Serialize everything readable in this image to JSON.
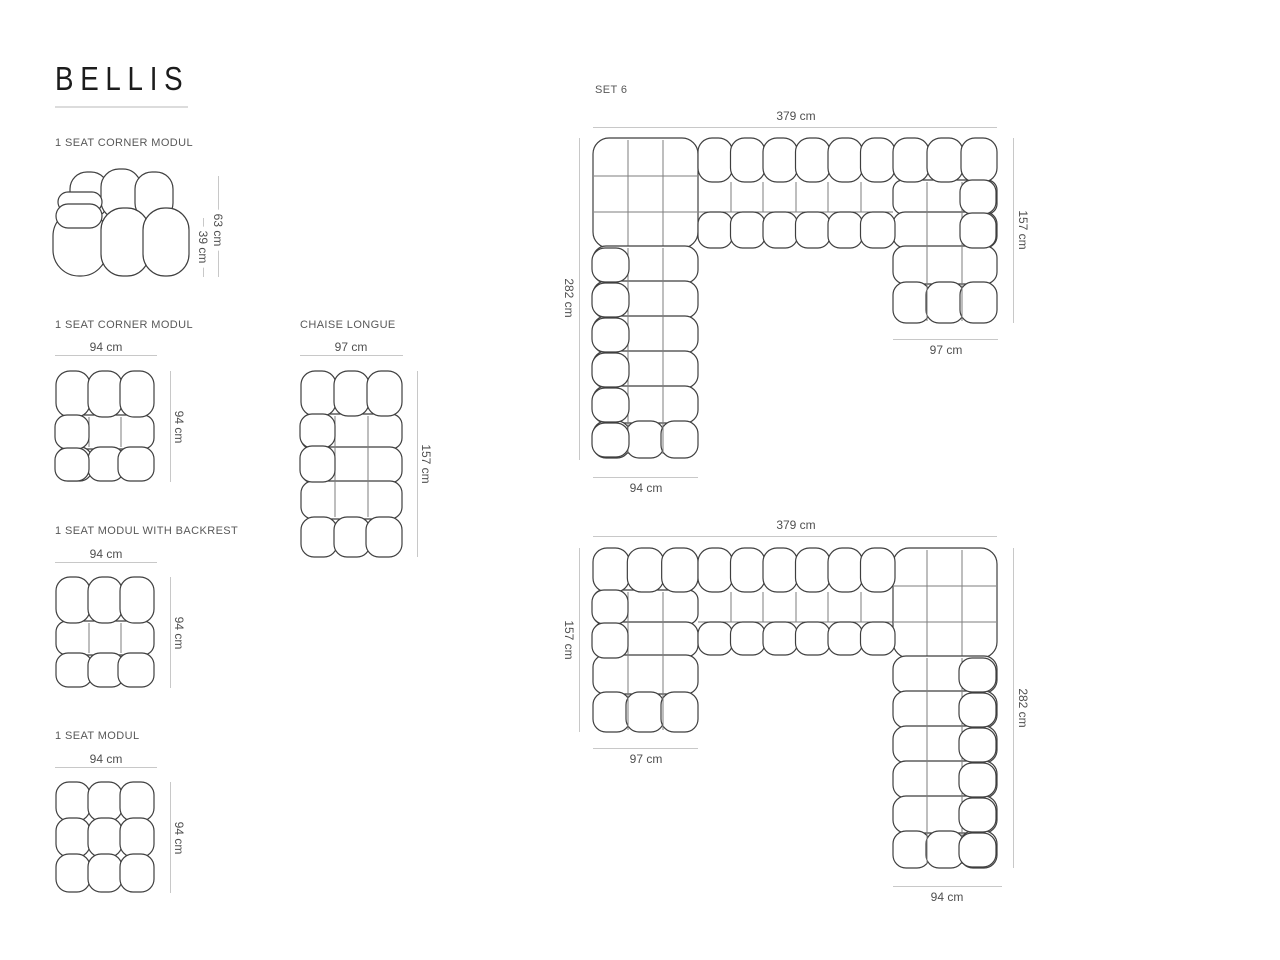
{
  "colors": {
    "title": "#1c1c1c",
    "underline": "#dcdcdc",
    "label_text": "#585858",
    "dim_text": "#4f4f4f",
    "dim_line": "#c8c8c8",
    "sketch_outline": "#3f3f3f",
    "sketch_grid": "#7d7d7d"
  },
  "header": {
    "title": "BELLIS"
  },
  "modules": {
    "corner_side": {
      "label": "1 SEAT CORNER MODUL",
      "total_height": "63 cm",
      "seat_height": "39 cm"
    },
    "corner_top": {
      "label": "1 SEAT CORNER MODUL",
      "width": "94 cm",
      "depth": "94 cm"
    },
    "chaise": {
      "label": "CHAISE LONGUE",
      "width": "97 cm",
      "depth": "157 cm"
    },
    "backrest": {
      "label": "1 SEAT MODUL WITH BACKREST",
      "width": "94 cm",
      "depth": "94 cm"
    },
    "plain": {
      "label": "1 SEAT MODUL",
      "width": "94 cm",
      "depth": "94 cm"
    }
  },
  "set6": {
    "label": "SET 6",
    "upper": {
      "total_width": "379 cm",
      "left_depth": "282 cm",
      "right_depth": "157 cm",
      "left_leg_width": "94 cm",
      "right_leg_width": "97 cm"
    },
    "lower": {
      "total_width": "379 cm",
      "left_depth": "157 cm",
      "right_depth": "282 cm",
      "left_leg_width": "97 cm",
      "right_leg_width": "94 cm"
    }
  }
}
